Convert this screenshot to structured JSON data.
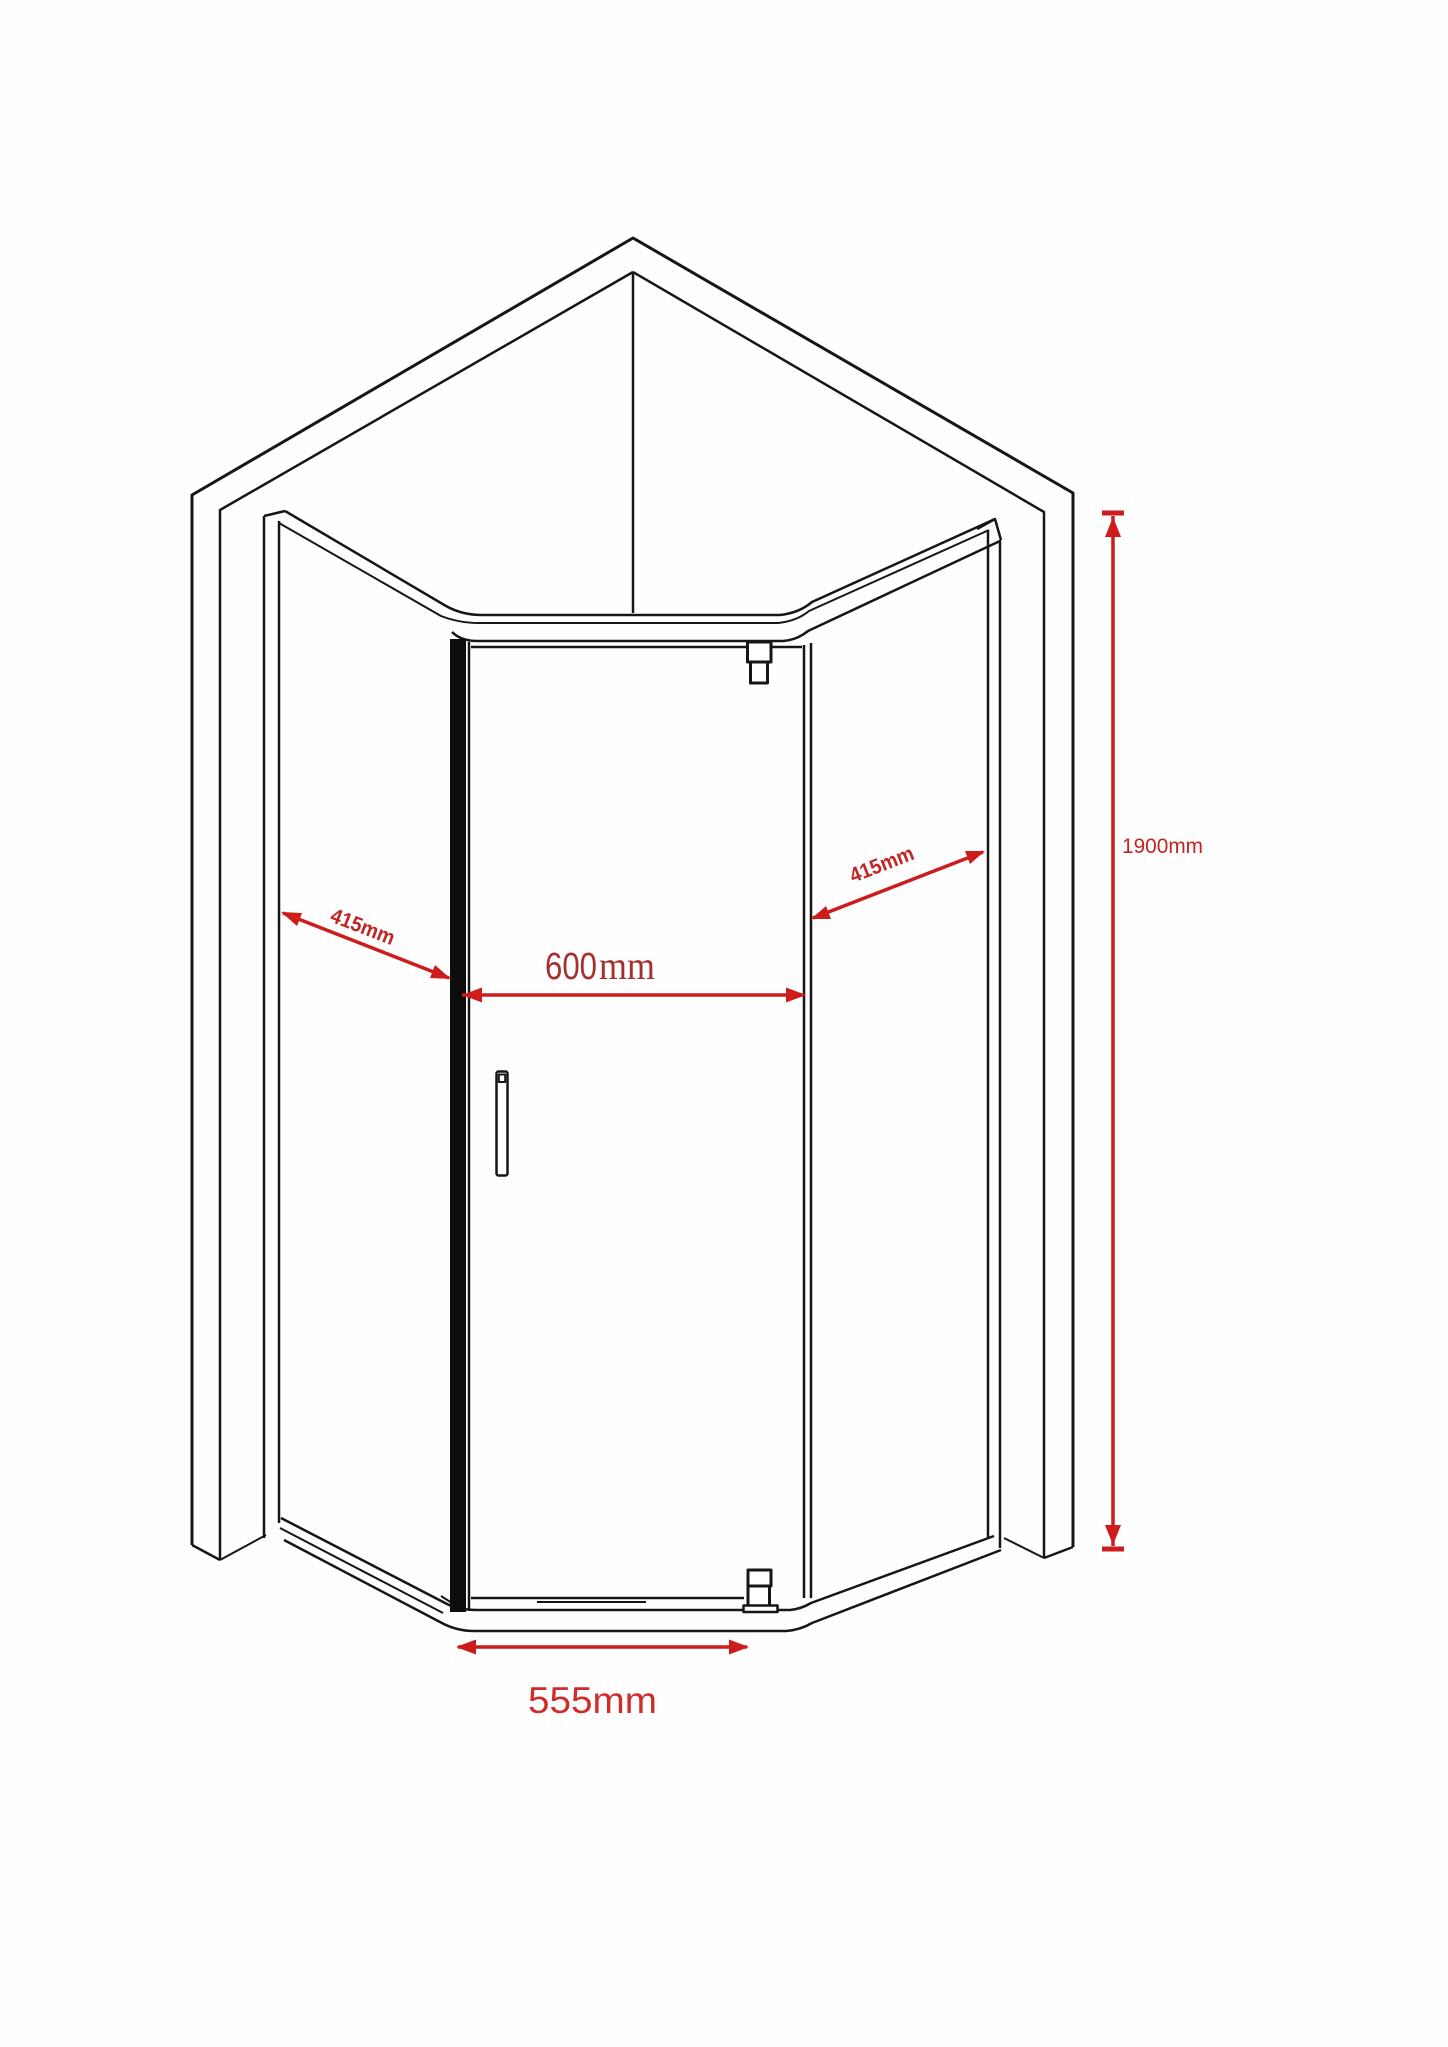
{
  "figure": {
    "type": "technical-dimension-drawing",
    "subject": "corner pentagon shower enclosure with pivot door",
    "view": "isometric line drawing"
  },
  "colors": {
    "line_black": "#161616",
    "dimension_red": "#cc1c1c",
    "label_red_dark": "#a53030",
    "label_red_bright": "#d02c2c",
    "background": "#ffffff"
  },
  "dimensions": {
    "left_panel_width": {
      "label": "415mm"
    },
    "right_panel_width": {
      "label": "415mm"
    },
    "door_opening_width": {
      "value": "600",
      "unit": "mm"
    },
    "base_width": {
      "label": "555mm"
    },
    "height": {
      "label": "1900mm"
    }
  }
}
